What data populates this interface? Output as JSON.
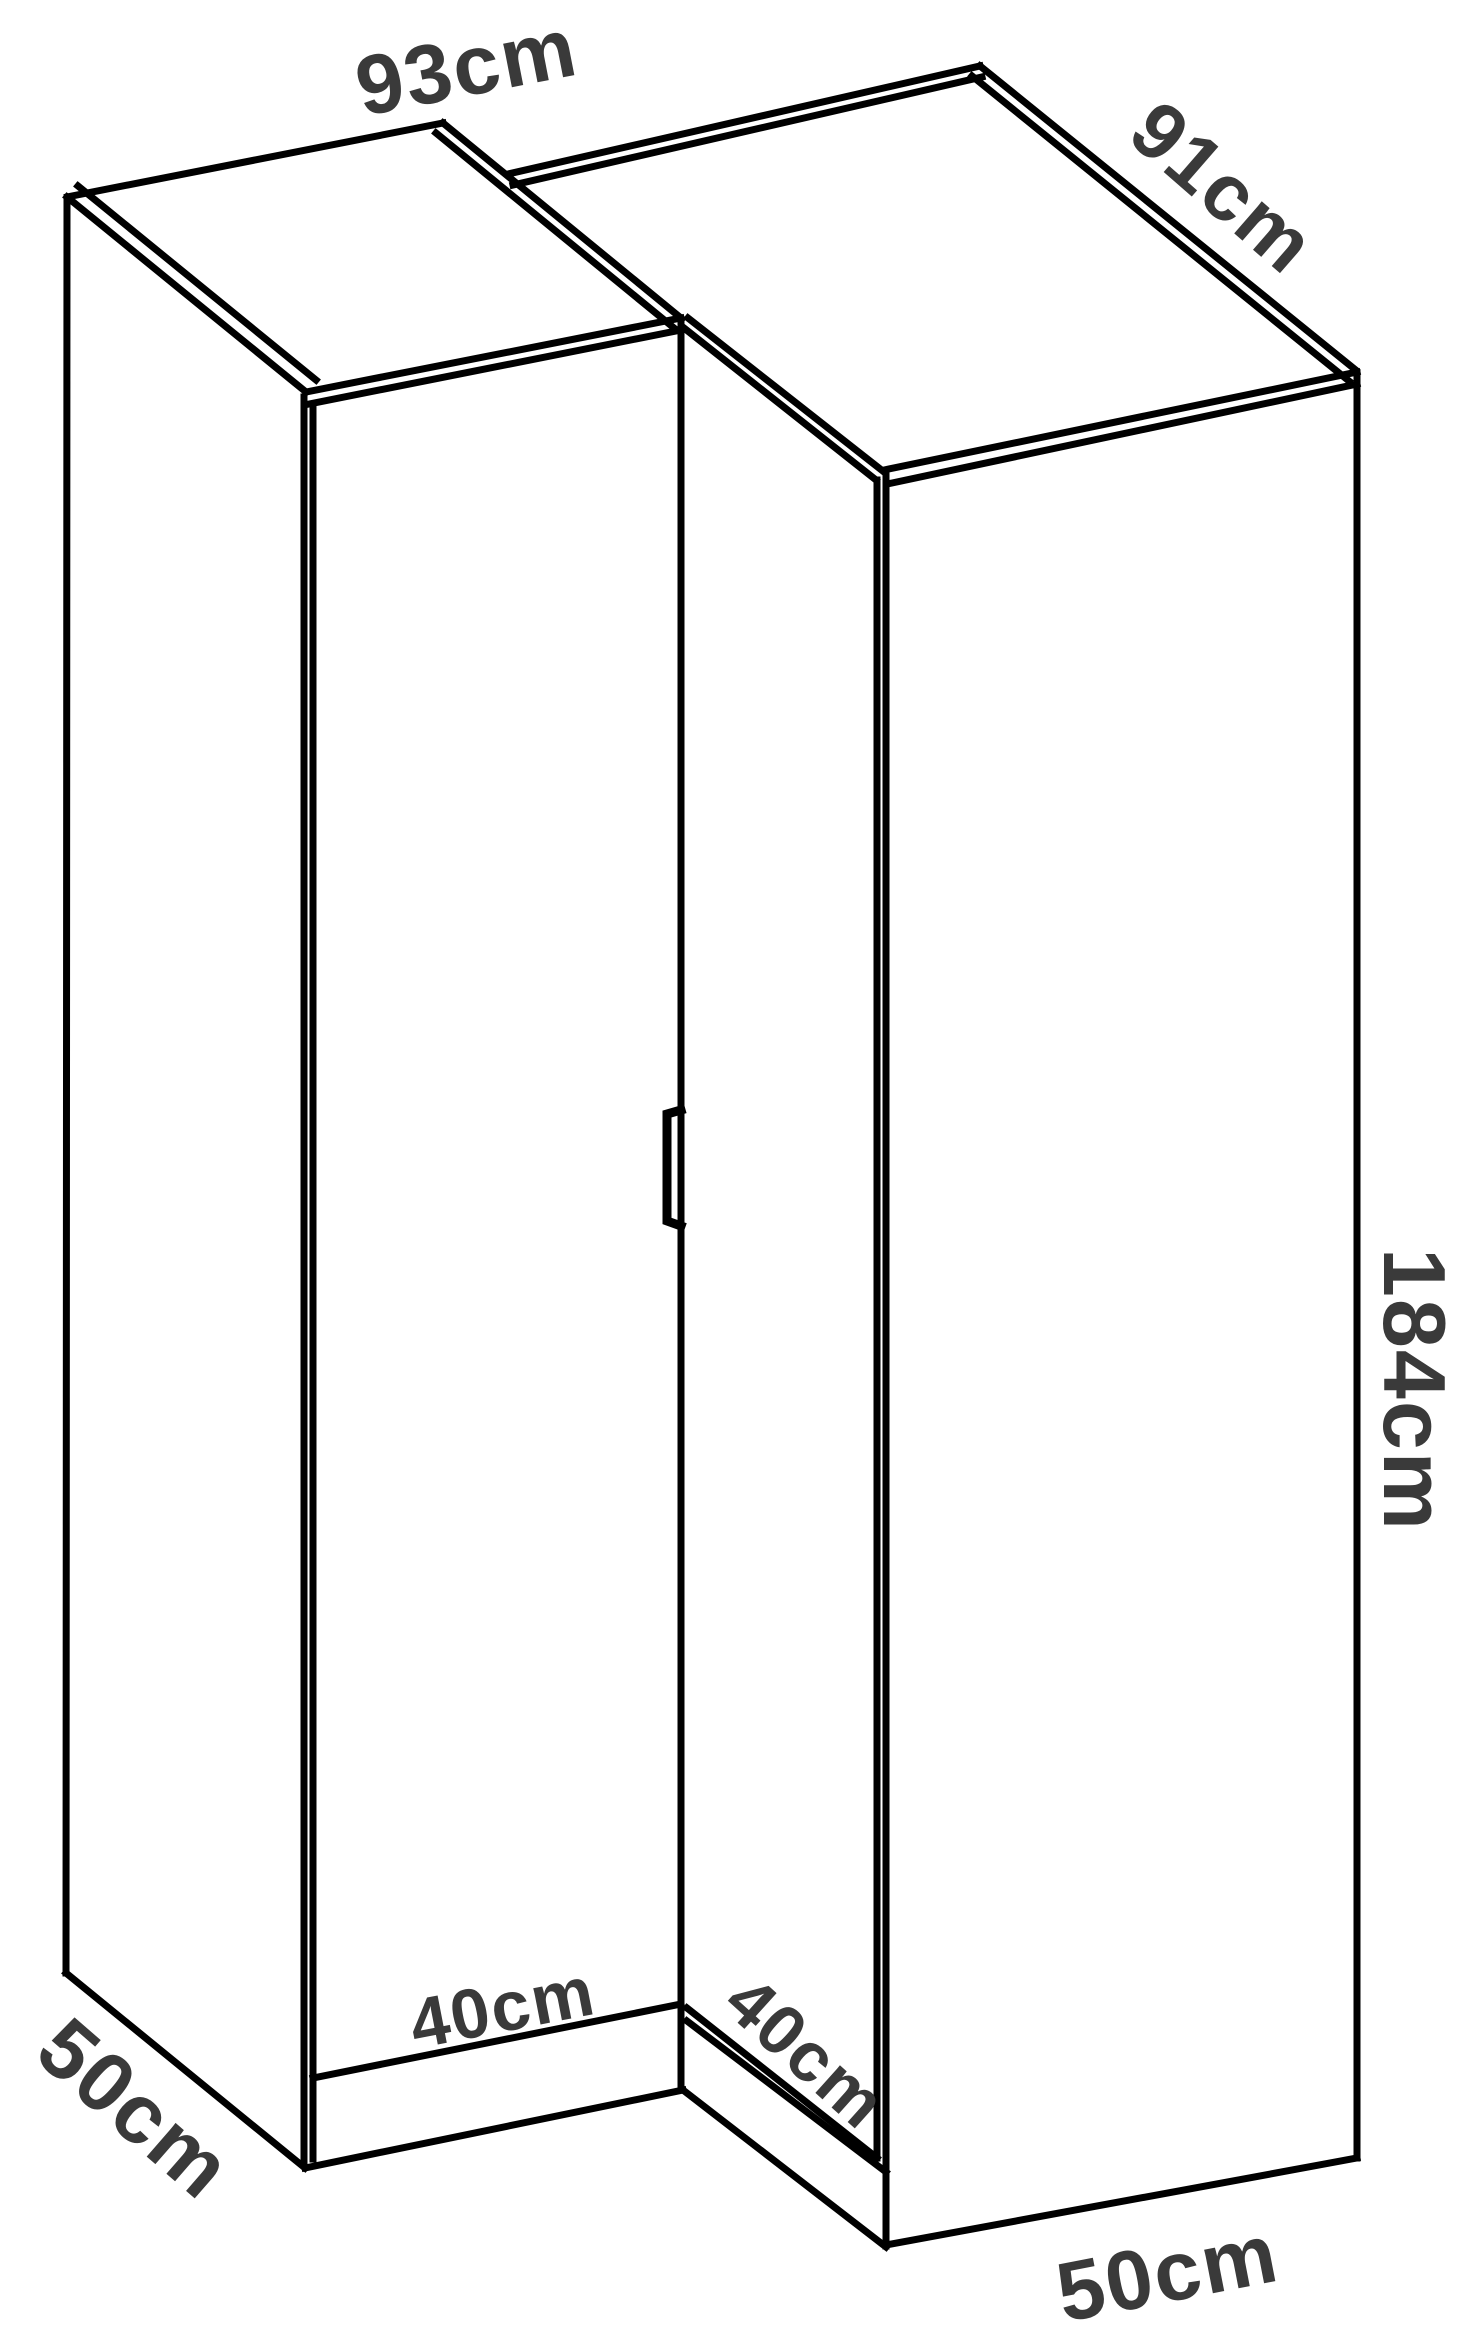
{
  "diagram": {
    "type": "isometric-furniture-dimension-drawing",
    "product": "corner-wardrobe",
    "background_color": "#ffffff",
    "line_color": "#000000",
    "label_color": "#3a3a3a",
    "labels": {
      "top_left_width": "93cm",
      "top_right_depth": "91cm",
      "height": "184cm",
      "left_door_width": "40cm",
      "right_door_width": "40cm",
      "bottom_left_depth": "50cm",
      "bottom_right_width": "50cm"
    }
  }
}
